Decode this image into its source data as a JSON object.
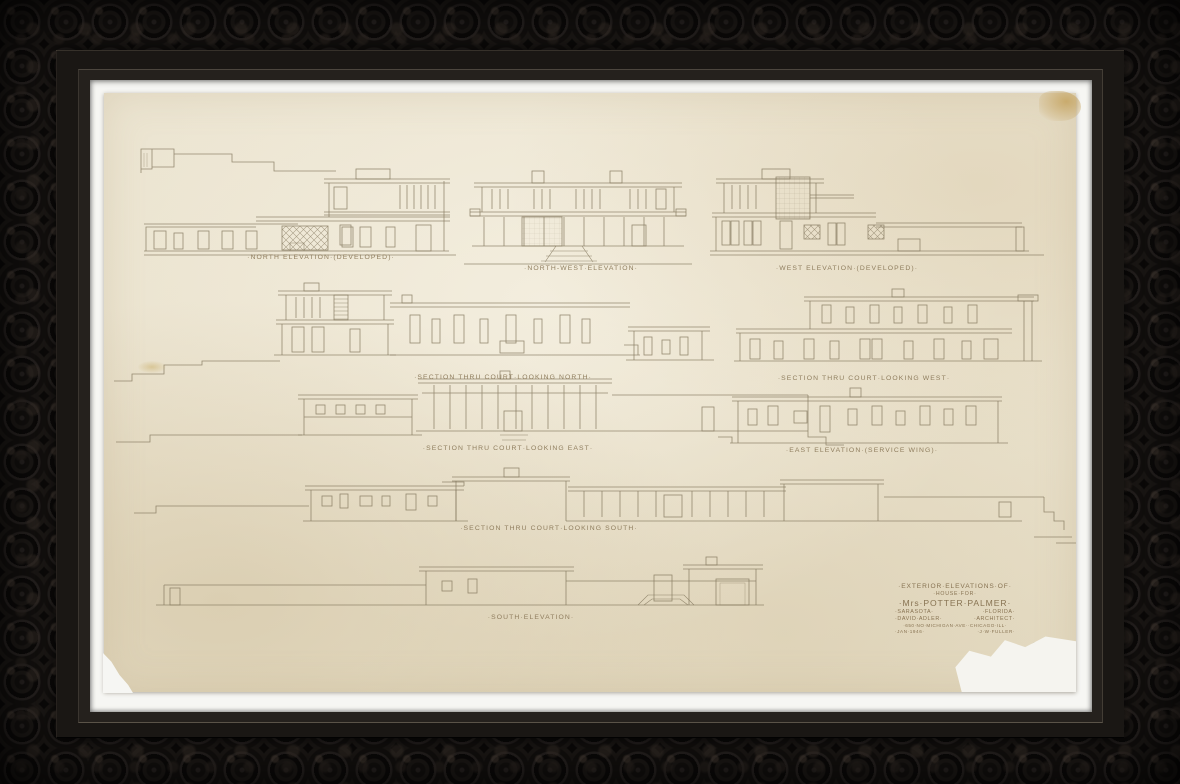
{
  "artwork": {
    "kind": "Framed architectural drawing — pencil exterior elevations on aged tracing paper",
    "labels": {
      "north": "·NORTH ELEVATION·(DEVELOPED)·",
      "northwest": "·NORTH-WEST·ELEVATION·",
      "west": "·WEST ELEVATION·(DEVELOPED)·",
      "section_north": "·SECTION THRU COURT·LOOKING NORTH·",
      "section_west": "·SECTION THRU COURT·LOOKING WEST·",
      "section_east": "·SECTION THRU COURT·LOOKING EAST·",
      "east_service": "·EAST ELEVATION·(SERVICE WING)·",
      "section_south": "·SECTION THRU COURT·LOOKING SOUTH·",
      "south": "·SOUTH·ELEVATION·"
    },
    "title_block": {
      "line1": "·EXTERIOR·ELEVATIONS·OF·",
      "line2": "·HOUSE·FOR·",
      "line3": "·Mrs·POTTER·PALMER·",
      "city": "·SARASOTA·",
      "state": "·FLORIDA·",
      "architect_name": "·DAVID·ADLER·",
      "architect_title": "·ARCHITECT·",
      "address": "·650·NO·MICHIGAN·AVE··CHICAGO·ILL·",
      "date": "·JAN·1946·",
      "drafter": "·J·W·FULLER·"
    },
    "sheet_number": "8",
    "colors": {
      "frame": "#141110",
      "mat": "#f6f6f3",
      "paper": "#eae2cd",
      "pencil": "#85795f",
      "tape_stain": "#bc923e"
    }
  }
}
